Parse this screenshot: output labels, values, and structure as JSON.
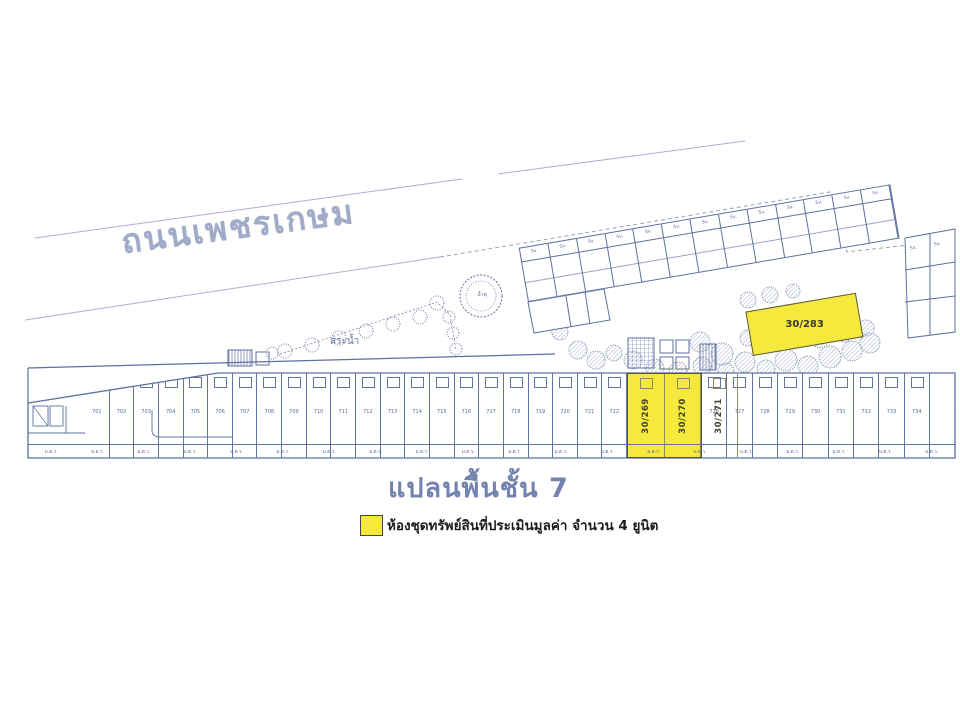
{
  "plan": {
    "road_label": "ถนนเพชรเกษม",
    "pond_label": "สระน้ำ",
    "fountain_label": "น้ำพุ",
    "floor_title": "แปลนพื้นชั้น 7"
  },
  "legend": {
    "text": "ห้องชุดทรัพย์สินที่ประเมินมูลค่า จำนวน 4 ยูนิต",
    "highlight_color": "#f6e93e",
    "unit_count": "4"
  },
  "highlighted_units": {
    "wing_unit": "30/283",
    "row_units": [
      "30/269",
      "30/270",
      "30/271"
    ]
  },
  "bottom_row": {
    "units_left": [
      "701",
      "702",
      "703",
      "704",
      "705",
      "706",
      "707",
      "708",
      "709",
      "710",
      "711",
      "712",
      "713",
      "714",
      "715",
      "716",
      "717",
      "718",
      "719",
      "720",
      "721",
      "722"
    ],
    "units_right": [
      "726",
      "727",
      "728",
      "729",
      "730",
      "731",
      "732",
      "733",
      "734"
    ],
    "balcony_labels": [
      "ม.ต.ว.",
      "ม.ต.ว.",
      "ม.ต.ว.",
      "ม.ต.ว.",
      "ม.ต.ว.",
      "ม.ต.ว.",
      "ม.ต.ว.",
      "ม.ต.ว.",
      "ม.ต.ว.",
      "ม.ต.ว.",
      "ม.ต.ว.",
      "ม.ต.ว.",
      "ม.ต.ว.",
      "ม.ต.ว.",
      "ม.ต.ว.",
      "ม.ต.ว.",
      "ม.ต.ว.",
      "ม.ต.ว.",
      "ม.ต.ว.",
      "ม.ต.ว."
    ]
  },
  "wing": {
    "sv_labels": [
      "Sv.",
      "Sv.",
      "Sv.",
      "Sv.",
      "Sv.",
      "Sv.",
      "Sv.",
      "Sv.",
      "Sv.",
      "Sv.",
      "Sv.",
      "Sv.",
      "Sv."
    ],
    "sv_right": [
      "Sv.",
      "Sv."
    ]
  },
  "colors": {
    "highlight": "#f6e93e",
    "line_blue": "#5f6f9e",
    "title_blue": "#7383b0"
  }
}
